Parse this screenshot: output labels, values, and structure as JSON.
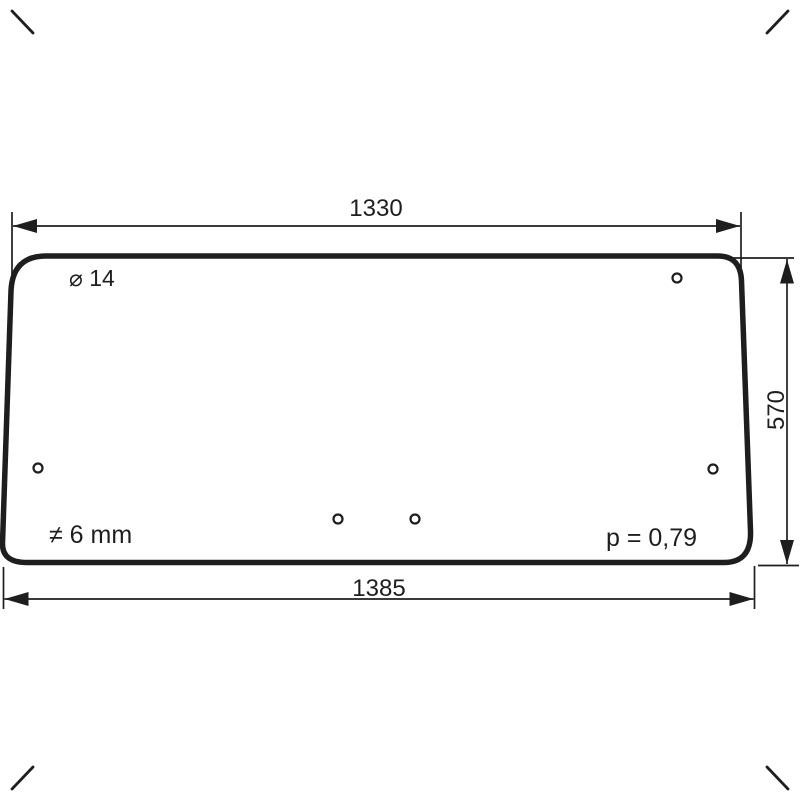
{
  "colors": {
    "ink": "#1e1e1e",
    "background": "#ffffff"
  },
  "drawing": {
    "dimensions": {
      "top_width": "1330",
      "bottom_width": "1385",
      "right_height": "570"
    },
    "labels": {
      "hole_diameter": "⌀ 14",
      "thickness": "≠ 6 mm",
      "weight_factor": "p = 0,79"
    },
    "holes": [
      {
        "cx": 677,
        "cy": 278,
        "r": 4.5
      },
      {
        "cx": 38,
        "cy": 468,
        "r": 4.5
      },
      {
        "cx": 713,
        "cy": 469,
        "r": 4.5
      },
      {
        "cx": 338,
        "cy": 519,
        "r": 4.5
      },
      {
        "cx": 415,
        "cy": 519,
        "r": 4.5
      }
    ]
  }
}
